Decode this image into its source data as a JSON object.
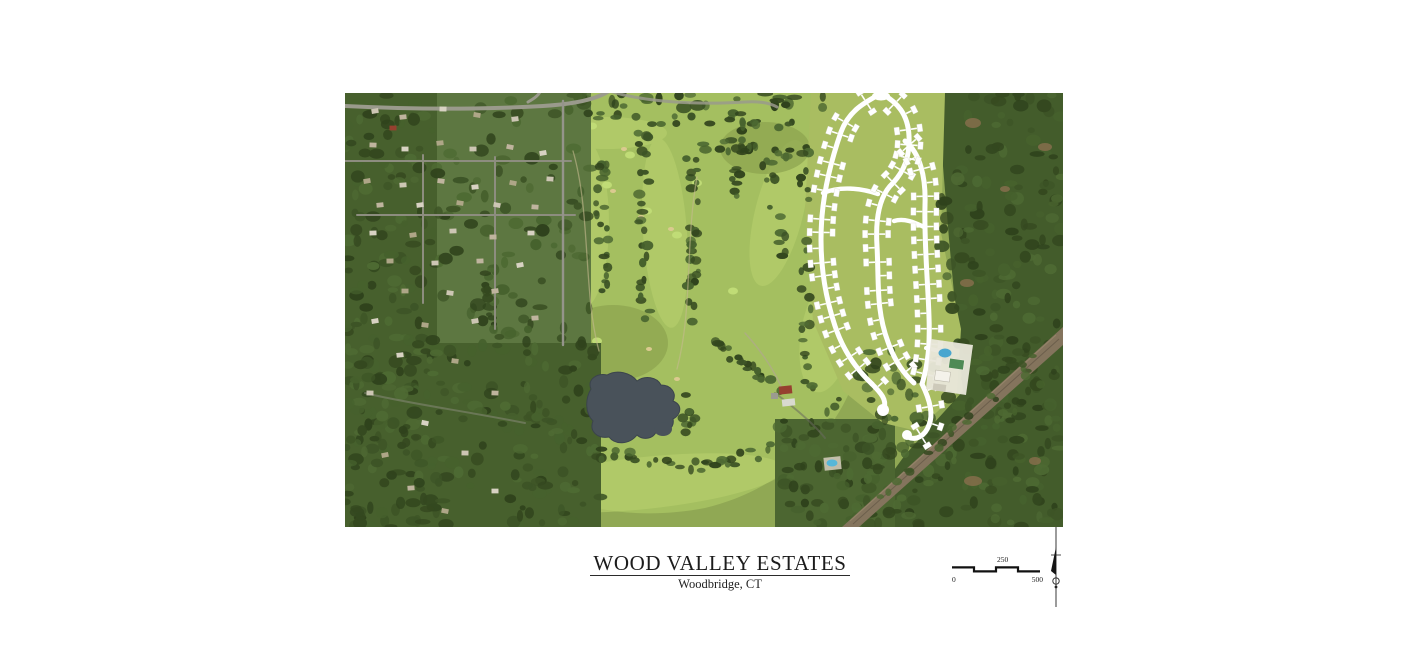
{
  "title_block": {
    "title": "WOOD VALLEY ESTATES",
    "subtitle": "Woodbridge, CT"
  },
  "scale_bar": {
    "zero_label": "0",
    "mid_label": "250",
    "max_label": "500"
  },
  "icons": {
    "north_arrow": "compass-needle-north-arrow"
  },
  "palette": {
    "page_bg": "#ffffff",
    "fairway_green": "#a4bf60",
    "fairway_light": "#b6d06c",
    "green_bright": "#c0dc76",
    "bunker_sand": "#dbca90",
    "forest_green": "#435c2b",
    "tree_dark_1": "#34481f",
    "tree_dark_2": "#3d5426",
    "tree_dark_3": "#46612d",
    "tree_dark_4": "#2f421c",
    "tree_dark_5": "#4e6a33",
    "pond_gray_blue": "#49525a",
    "dev_road_white": "#ffffff",
    "dev_lawn": "#a9bd61",
    "pool_blue": "#4aa6cf",
    "tennis_green": "#4e8a55",
    "clubhouse_red": "#96402f",
    "dirt_brown": "#8a6f4e",
    "river_road_tan": "#84745d",
    "ink": "#1a1a1a"
  }
}
